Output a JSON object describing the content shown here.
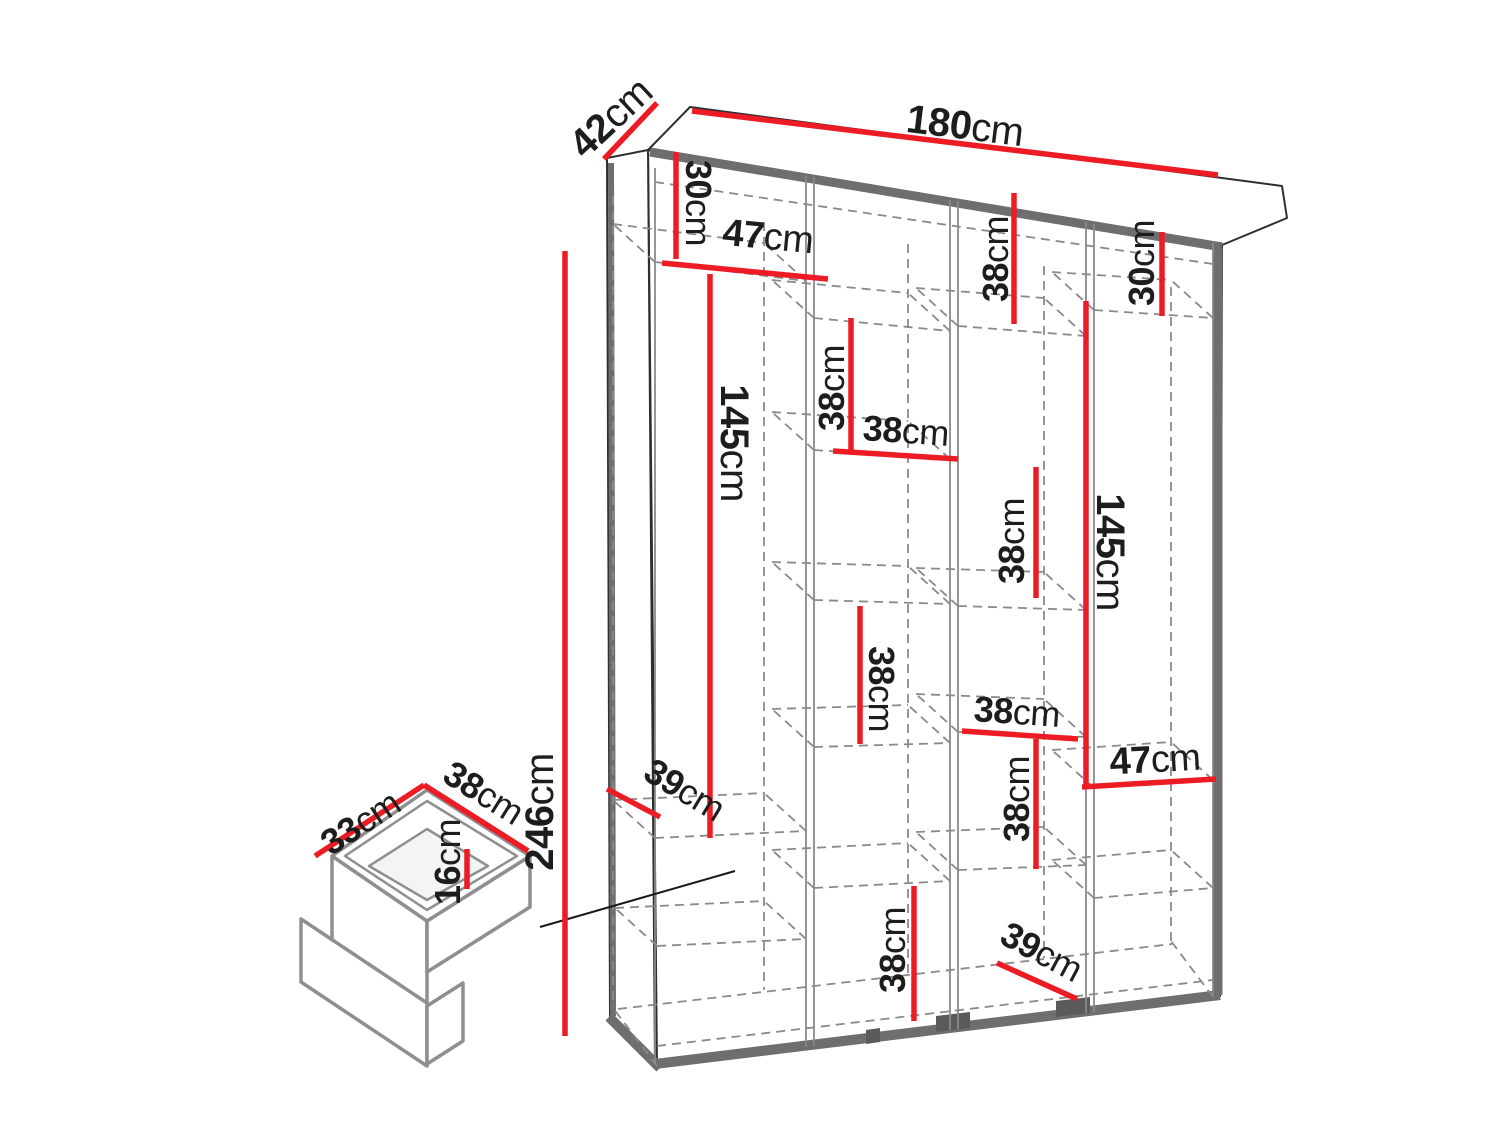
{
  "diagram": {
    "kind": "furniture-dimension-diagram",
    "subject": "wardrobe with open front, internal shelving and drawer detail",
    "units": "cm",
    "colors": {
      "dimension_line": "#ed1c24",
      "text": "#1d1d1b",
      "outline": "#2e2e2e",
      "panel_edge": "#6e6e6e",
      "hidden_edge": "#8a8a8a",
      "background": "#ffffff"
    }
  },
  "wardrobe": {
    "overall": {
      "width": {
        "value": "180",
        "unit": "cm"
      },
      "depth": {
        "value": "42",
        "unit": "cm"
      },
      "height": {
        "value": "246",
        "unit": "cm"
      }
    },
    "interior": {
      "col1_top_gap_height": {
        "value": "30",
        "unit": "cm"
      },
      "col1_shelf_width": {
        "value": "47",
        "unit": "cm"
      },
      "col1_hanging_height": {
        "value": "145",
        "unit": "cm"
      },
      "col2_top_section_height": {
        "value": "38",
        "unit": "cm"
      },
      "col2_shelf_width": {
        "value": "38",
        "unit": "cm"
      },
      "col2_middle_section_height": {
        "value": "38",
        "unit": "cm"
      },
      "col2_bottom_section_height": {
        "value": "38",
        "unit": "cm"
      },
      "col3_top_section_height": {
        "value": "38",
        "unit": "cm"
      },
      "col3_middle_section_height": {
        "value": "38",
        "unit": "cm"
      },
      "col3_shelf_width": {
        "value": "38",
        "unit": "cm"
      },
      "col3_lower_section_height": {
        "value": "38",
        "unit": "cm"
      },
      "col3_bottom_shelf_depth": {
        "value": "39",
        "unit": "cm"
      },
      "col4_top_gap_height": {
        "value": "30",
        "unit": "cm"
      },
      "col4_hanging_height": {
        "value": "145",
        "unit": "cm"
      },
      "col4_shelf_width": {
        "value": "47",
        "unit": "cm"
      },
      "left_shelf_depth": {
        "value": "39",
        "unit": "cm"
      }
    },
    "drawer": {
      "depth": {
        "value": "33",
        "unit": "cm"
      },
      "width": {
        "value": "38",
        "unit": "cm"
      },
      "height": {
        "value": "16",
        "unit": "cm"
      }
    }
  }
}
